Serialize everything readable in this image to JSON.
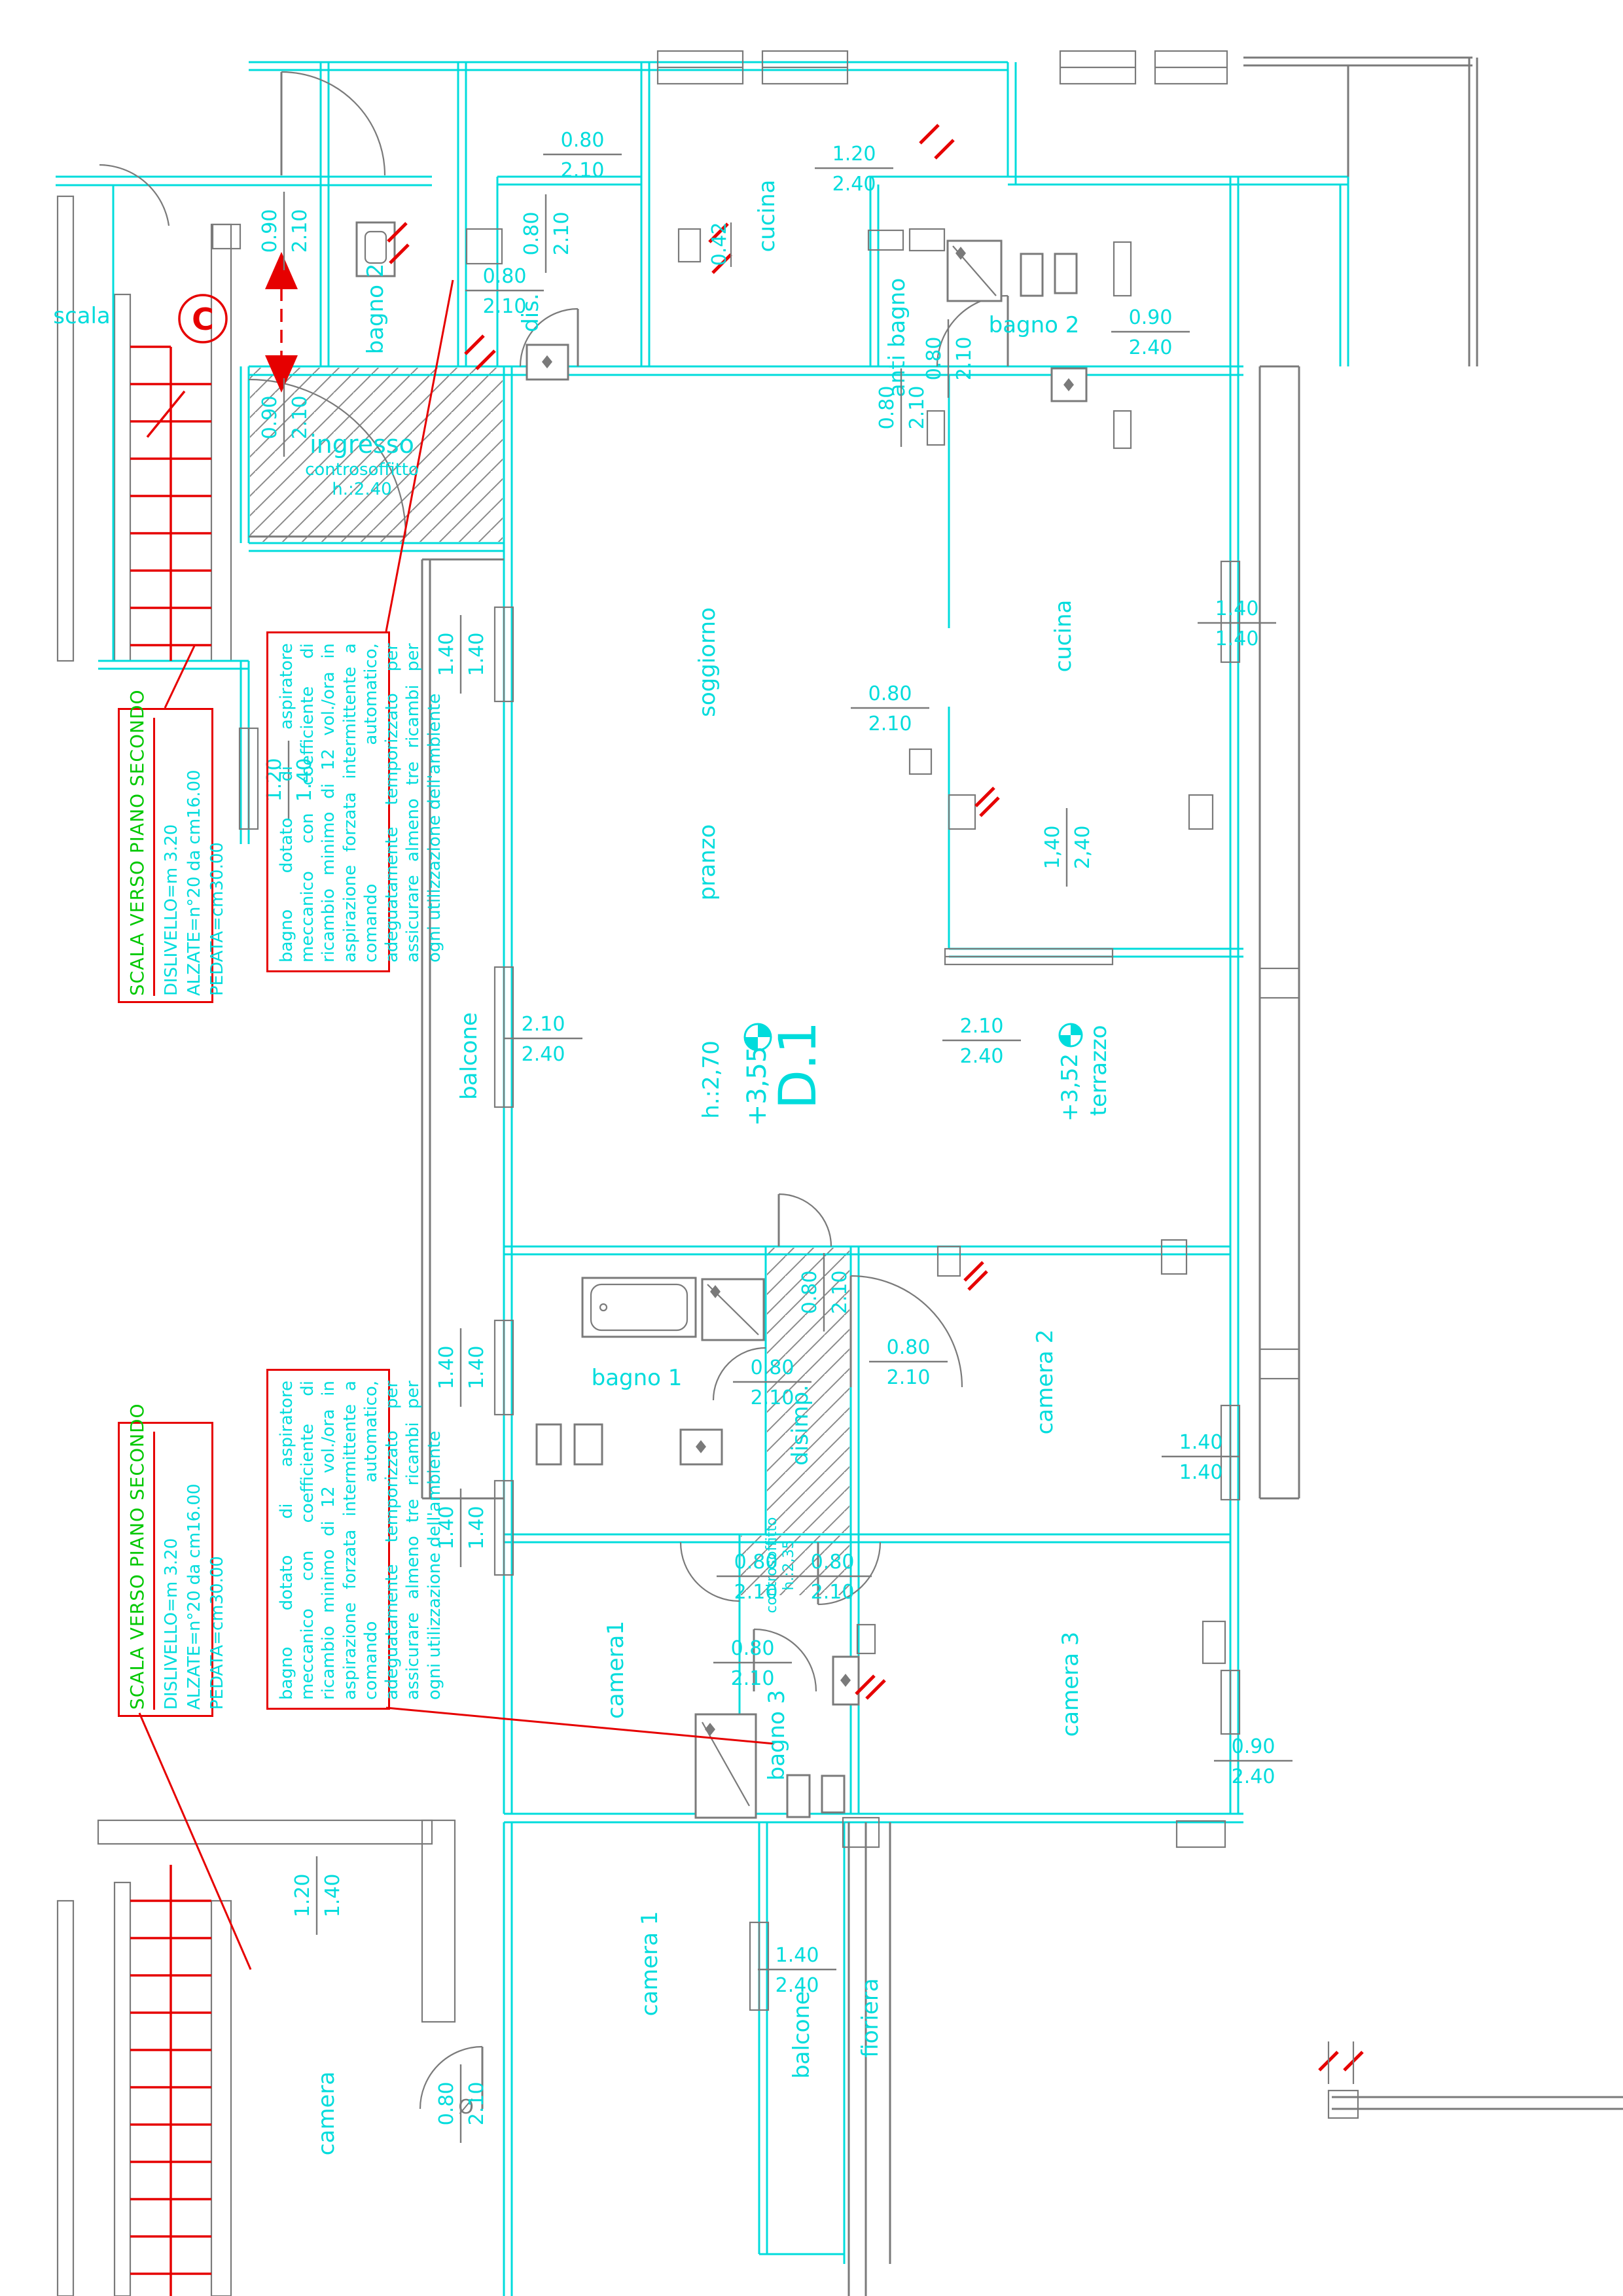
{
  "colors": {
    "plan_line": "#00dcdc",
    "annotation_red": "#e60000",
    "stair_note_green": "#00c800",
    "detail_gray": "#7a7a7a"
  },
  "plan": {
    "unit": "D.1",
    "unit_level": "+3,55",
    "unit_height": "h.:2,70",
    "terrace_level": "+3,52",
    "section_marker": "C",
    "door_symbol": "Ø"
  },
  "rooms": [
    {
      "id": "scala",
      "label": "scala"
    },
    {
      "id": "bagno2-left",
      "label": "bagno 2"
    },
    {
      "id": "dis",
      "label": "dis."
    },
    {
      "id": "cucina-top",
      "label": "cucina"
    },
    {
      "id": "anti-bagno",
      "label": "anti bagno"
    },
    {
      "id": "bagno2-right",
      "label": "bagno 2"
    },
    {
      "id": "soggiorno",
      "label": "soggiorno"
    },
    {
      "id": "pranzo",
      "label": "pranzo"
    },
    {
      "id": "cucina",
      "label": "cucina"
    },
    {
      "id": "balcone-left",
      "label": "balcone"
    },
    {
      "id": "terrazzo",
      "label": "terrazzo"
    },
    {
      "id": "bagno1",
      "label": "bagno 1"
    },
    {
      "id": "disimp",
      "label": "disimp."
    },
    {
      "id": "camera2",
      "label": "camera 2"
    },
    {
      "id": "camera1-mid",
      "label": "camera1"
    },
    {
      "id": "bagno3",
      "label": "bagno 3"
    },
    {
      "id": "camera3",
      "label": "camera 3"
    },
    {
      "id": "camera1-bottom",
      "label": "camera 1"
    },
    {
      "id": "balcone-bottom",
      "label": "balcone"
    },
    {
      "id": "fioriera",
      "label": "fioriera"
    },
    {
      "id": "camera-cut",
      "label": "camera"
    }
  ],
  "ingresso": {
    "name": "ingresso",
    "ceiling": "controsoffitto",
    "height": "h.:2.40"
  },
  "ceiling_note": {
    "line1": "controsoffitto",
    "line2": "h.:2,35"
  },
  "dims": [
    {
      "a": "0.90",
      "b": "2.10"
    },
    {
      "a": "0.90",
      "b": "2.10"
    },
    {
      "a": "0.80",
      "b": "2.10"
    },
    {
      "a": "0.80",
      "b": "2.10"
    },
    {
      "a": "0.80",
      "b": "2.10"
    },
    {
      "a": "0.42",
      "b": ""
    },
    {
      "a": "1.20",
      "b": "2.40"
    },
    {
      "a": "0.80",
      "b": "2.10"
    },
    {
      "a": "0.80",
      "b": "2.10"
    },
    {
      "a": "0.90",
      "b": "2.40"
    },
    {
      "a": "1.40",
      "b": "1.40"
    },
    {
      "a": "1.40",
      "b": "1.40"
    },
    {
      "a": "0.80",
      "b": "2.10"
    },
    {
      "a": "1,40",
      "b": "2,40"
    },
    {
      "a": "2.10",
      "b": "2.40"
    },
    {
      "a": "2.10",
      "b": "2.40"
    },
    {
      "a": "1.20",
      "b": "1.40"
    },
    {
      "a": "1.40",
      "b": "1.40"
    },
    {
      "a": "0.80",
      "b": "2.10"
    },
    {
      "a": "0.80",
      "b": "2.10"
    },
    {
      "a": "0.80",
      "b": "2.10"
    },
    {
      "a": "1.40",
      "b": "1.40"
    },
    {
      "a": "1.40",
      "b": "1.40"
    },
    {
      "a": "0.80",
      "b": "2.10"
    },
    {
      "a": "0.80",
      "b": "2.10"
    },
    {
      "a": "0.80",
      "b": "2.10"
    },
    {
      "a": "0.90",
      "b": "2.40"
    },
    {
      "a": "1.40",
      "b": "2.40"
    },
    {
      "a": "1.20",
      "b": "1.40"
    },
    {
      "a": "0.80",
      "b": "2.10"
    }
  ],
  "note_box": {
    "text": "bagno dotato di aspiratore meccanico con coefficiente di ricambio minimo di 12 vol./ora in aspirazione forzata intermittente a comando automatico, adeguatamente temporizzato per assicurare almeno tre ricambi per ogni utilizzazione dell'ambiente"
  },
  "stair_box": {
    "title": "SCALA VERSO PIANO SECONDO",
    "line1": "DISLIVELLO=m  3.20",
    "line2": "ALZATE=n°20  da  cm16.00",
    "line3": "PEDATA=cm30.00"
  }
}
